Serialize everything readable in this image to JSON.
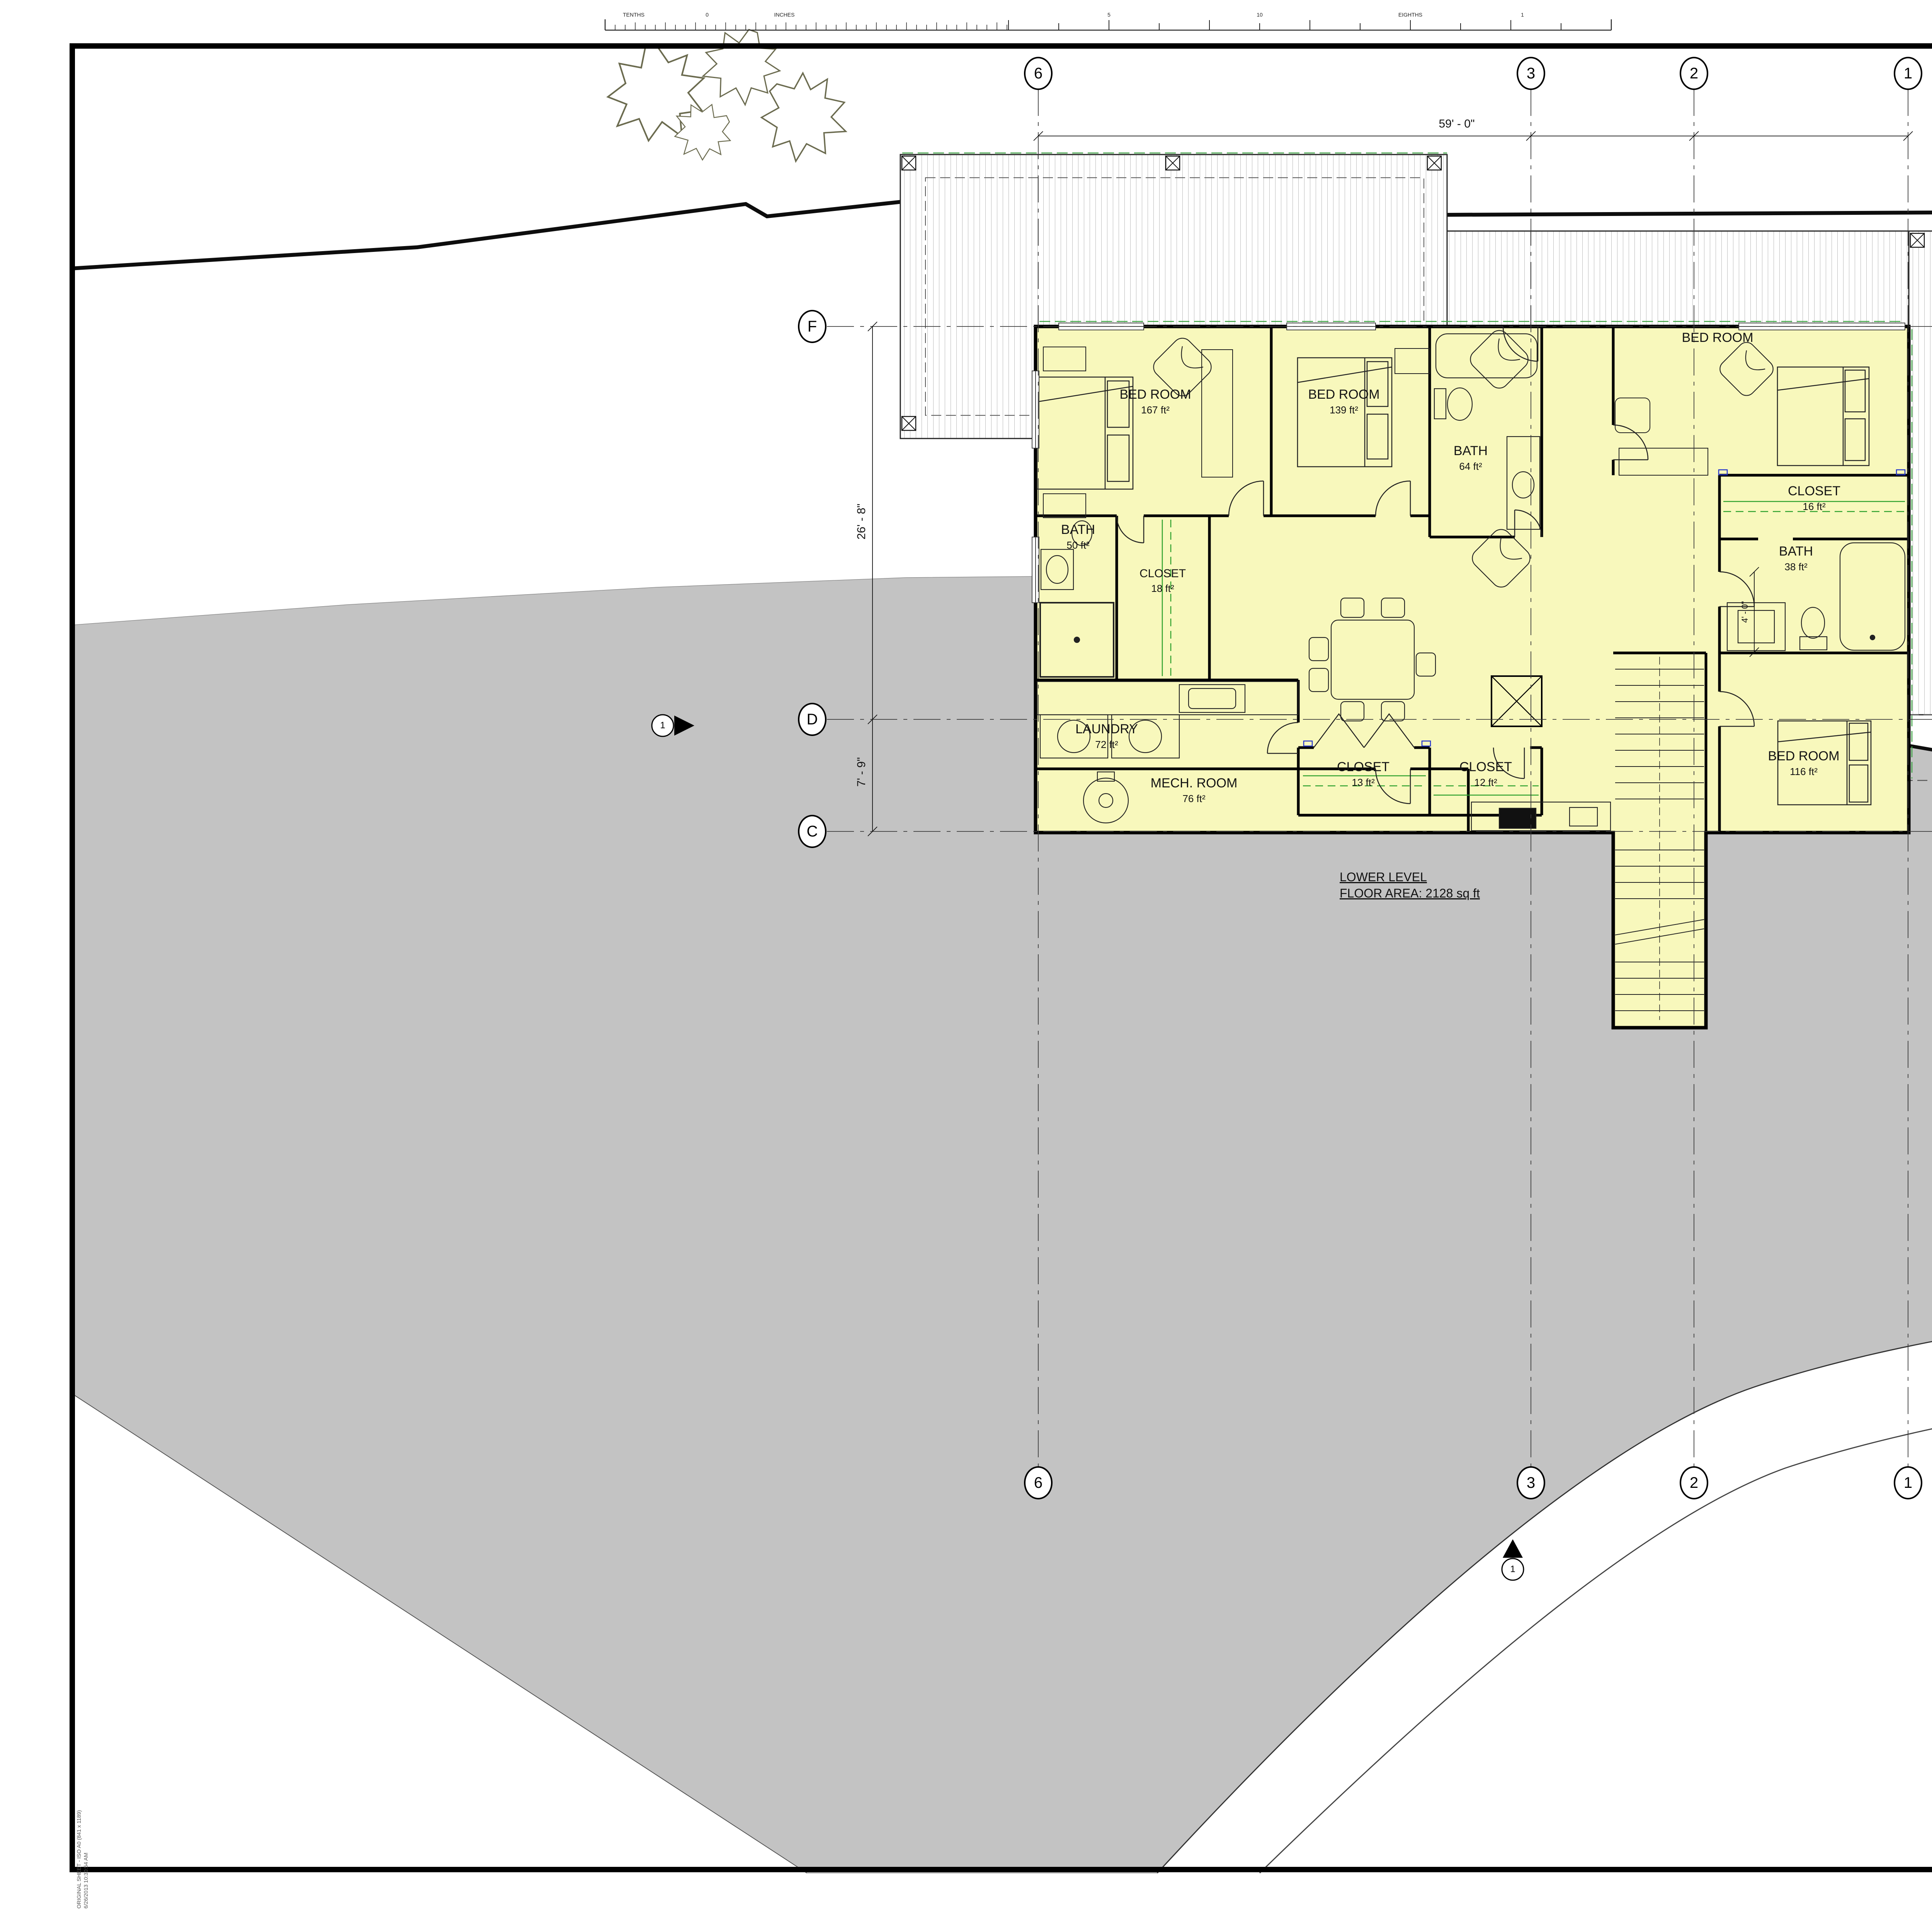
{
  "colors": {
    "plan_highlight": "#f8f8bc",
    "terrain_gray": "#c3c3c3",
    "closet_rod_green": "#2ca02c",
    "tag_blue": "#2233cc"
  },
  "ruler": {
    "labels": [
      "TENTHS",
      "0",
      "INCHES",
      "5",
      "10",
      "EIGHTHS",
      "1"
    ]
  },
  "reference_table": {
    "header": "REFERENCE DRAWING No.",
    "rev": "REV"
  },
  "notes": {
    "title": "NOTES:",
    "lines": [
      "- ALL EXISTING INFORMATION IS BASED ON AVAILABLE RECORDS AND SHALL NOT BE CONSTRUED",
      "  TO BE COMPLETE OR ACCURATE",
      "- EXISTING PLANIMETRIC DETAIL OBTAINED FROM AERIAL PHOTOGRAPHY DATED DECEMBER 1985",
      "- HORIZONTAL ACCURACY OF EXISTING PLANIMETRY +/- 1.0 METRE",
      "- EXISTING BUILDING DIMENSIONS SHOWN ARE ROOF OUTLINES",
      "- LOCATIONS SHOWN OF EXISTING SERVICES TO BUILDINGS ARE APPROXIMATE",
      "- ELEVATIONS ARE GEODETIC",
      "- GRID COORDINATES SHOWN ARE BASED ON THE PROJECT GROUND COORDINATE SYSTEM AS",
      "  SHOWN ON \"SURVEY CONTROL DRAWING\" PRODUCED BY MATSON PECK & TOPLISS"
    ]
  },
  "construction_notes": {
    "title": "CONSTRUCTION NOTES:"
  },
  "revision_table": {
    "rev": "REV",
    "date": "DATE",
    "issued_for": "ISSUED FOR",
    "dr": "DR",
    "ch": "CH",
    "ap": "AP",
    "yr": "YR"
  },
  "stamp_area": {
    "consultant_logo": "CONSULTANT LOGO",
    "p_eng_stamp": "P.ENG STAMP",
    "copyright_title": "Copyright Reserved",
    "copyright_body": "This drawing as an instrument of service is the property of Walter Francl Architecture Inc. and may not be reproduced without the firm's permission. All information shown on the drawing is for the use in this specific project only and shall not be used otherwise without written permission from this office. Contractors shall verify and be responsible for all dimensions on the job and this office shall be informed of any discrepancies and variations shown on this drawing. Do no scale drawings.",
    "location_map": "LOCATION MAP"
  },
  "project": {
    "title": "Liang Residence",
    "record_drawing": "RECORD DRAWING:",
    "contractor_signoff": "CONTRACTOR AS-BUILT SIGN-OFF:",
    "fap_number": "FAP NUMBER:",
    "project_no": "PROJECT No.",
    "consultant_project_no": "CONSULTANT PROJECT No.",
    "subject": "SUBJECT:"
  },
  "sheet_info": {
    "scale_label": "SCALE:",
    "scale_value": "1/4\" = 1'-0\"",
    "dwg_size_label": "DWG SIZE:",
    "dwg_size_value": "A0",
    "sheet_no_label": "SHEET No.",
    "sheet_value": "SHEET:",
    "consultant_dwg_no": "CONSULTANT DWG No.",
    "eng_services_dwg_no": "ENG SERVICES DWG No."
  },
  "index_row": {
    "headers": [
      "GRID No.",
      "AREA & LEVEL",
      "DISC.",
      "TYPE",
      "SEQUENCE No.",
      "DEMO",
      "REV."
    ],
    "dash": "—"
  },
  "plan": {
    "summary_line1": "LOWER LEVEL",
    "summary_line2": "FLOOR AREA: 2128 sq ft",
    "rooms": [
      {
        "name": "BED ROOM",
        "area": "167 ft²"
      },
      {
        "name": "BED ROOM",
        "area": "139 ft²"
      },
      {
        "name": "BED ROOM",
        "area": ""
      },
      {
        "name": "BED ROOM",
        "area": "116 ft²"
      },
      {
        "name": "BATH",
        "area": "50 ft²"
      },
      {
        "name": "BATH",
        "area": "64 ft²"
      },
      {
        "name": "BATH",
        "area": "38 ft²"
      },
      {
        "name": "CLOSET",
        "area": "18 ft²"
      },
      {
        "name": "CLOSET",
        "area": "13 ft²"
      },
      {
        "name": "CLOSET",
        "area": "12 ft²"
      },
      {
        "name": "CLOSET",
        "area": "16 ft²"
      },
      {
        "name": "LAUNDRY",
        "area": "72 ft²"
      },
      {
        "name": "MECH. ROOM",
        "area": "76 ft²"
      }
    ],
    "grid_cols": [
      "6",
      "3",
      "2",
      "1"
    ],
    "grid_rows": [
      "F",
      "D",
      "C"
    ],
    "dims": {
      "top": "59' - 0\"",
      "left_upper": "26' - 8\"",
      "left_lower": "7' - 9\"",
      "stair": "4' - 0\""
    },
    "marker_no": "1"
  },
  "plot_stamp": {
    "line1": "ORIGINAL SHEET - ISO A0 (841 x 1189)",
    "line2": "6/26/2013 10:30:54 AM"
  }
}
